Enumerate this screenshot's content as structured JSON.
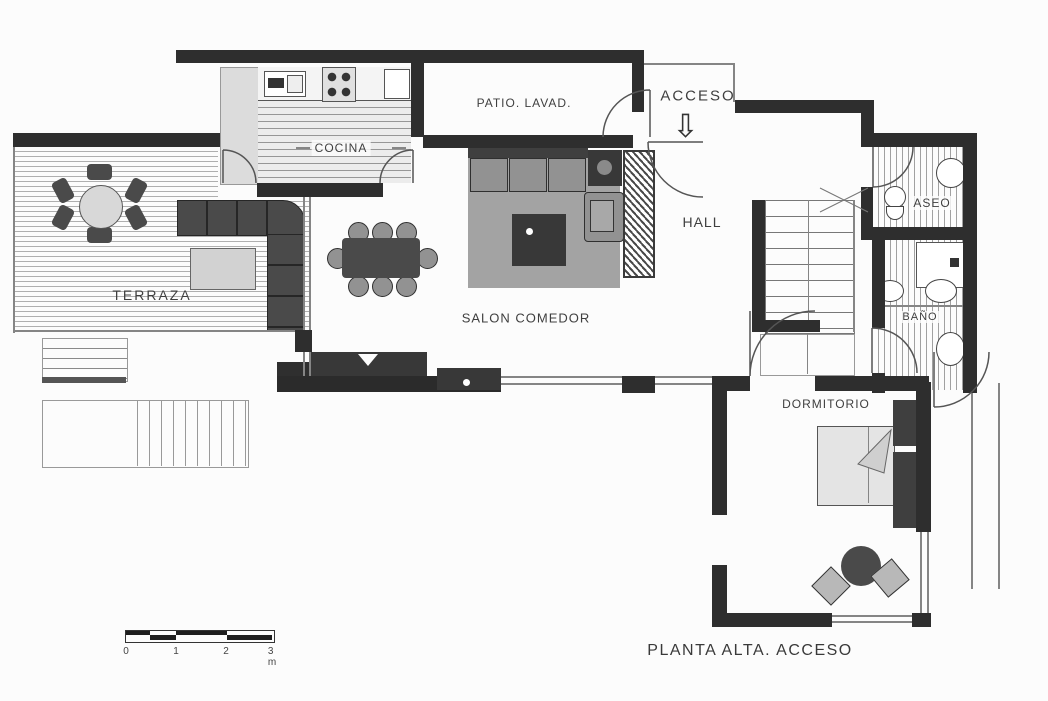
{
  "title": "PLANTA ALTA. ACCESO",
  "rooms": {
    "cocina": "COCINA",
    "patio_lavadero": "PATIO. LAVAD.",
    "acceso": "ACCESO",
    "hall": "HALL",
    "terraza": "TERRAZA",
    "salon_comedor": "SALON COMEDOR",
    "aseo": "ASEO",
    "bano": "BAÑO",
    "dormitorio": "DORMITORIO"
  },
  "annotations": {
    "acceso_arrow": "⇩"
  },
  "scale_bar": {
    "labels": [
      "0",
      "1",
      "2",
      "3 m"
    ]
  },
  "colors": {
    "wall": "#2e2e2e",
    "thin": "#858585",
    "furn_dark": "#4a4a4a",
    "furn_mid": "#929292",
    "furn_light": "#d8d8d8",
    "rug": "#a3a3a3",
    "media": "#383838",
    "label": "#3f3f3f",
    "paper": "#fcfcfc"
  }
}
